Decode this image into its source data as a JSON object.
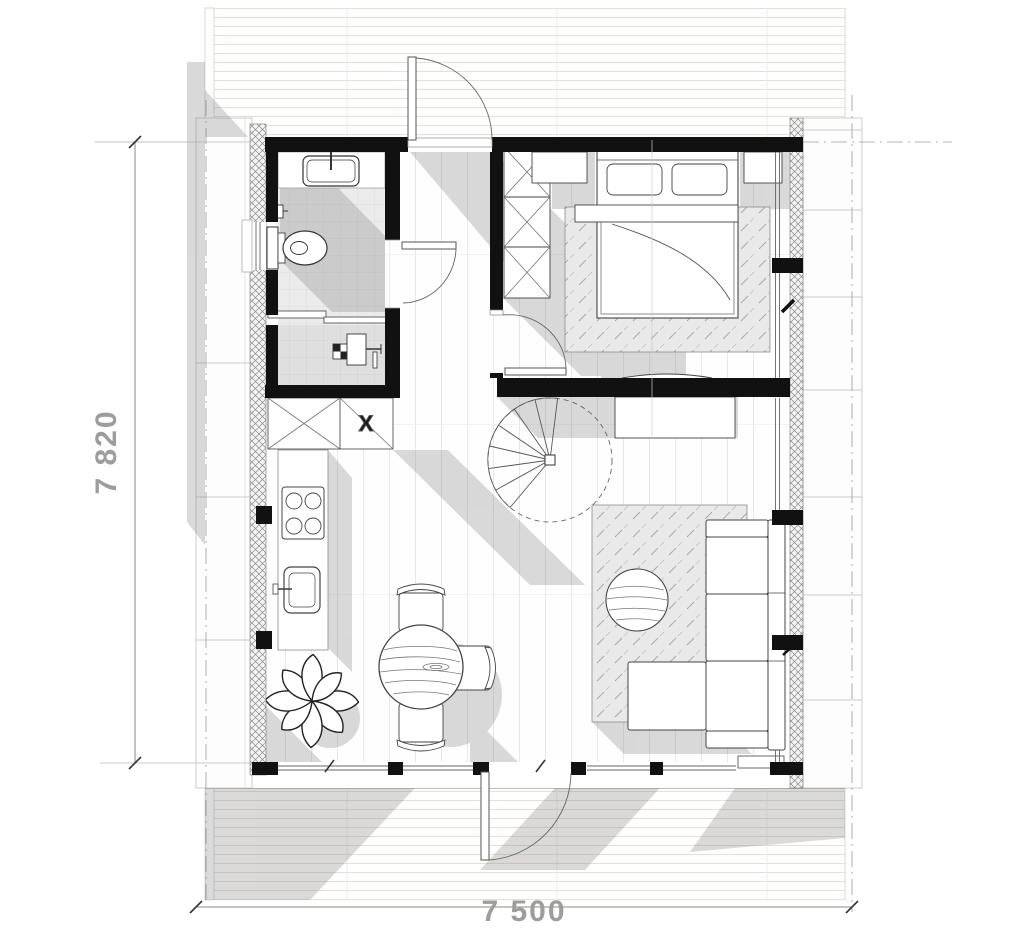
{
  "plan": {
    "dimensions": {
      "height_label": "7 820",
      "width_label": "7 500"
    },
    "markers": {
      "closet_mark": "X"
    },
    "colors": {
      "wall": "#111111",
      "dimension_text": "#9d9d9d",
      "shadow": "#d7d7d7",
      "deck_plank_line": "#eadfd2",
      "floor_plank_line": "#e8e8e8",
      "bathroom_tile": "#ebebeb",
      "furniture_outline": "#444444"
    },
    "elements": [
      "top-deck",
      "bottom-terrace",
      "left-walkway",
      "right-walkway",
      "entry-door",
      "bathroom",
      "vanity-sink",
      "toilet",
      "toilet-paper-holder",
      "sliding-door",
      "utility-room",
      "floor-drain",
      "water-heater",
      "closet",
      "wardrobe",
      "kitchen-counter",
      "cooktop",
      "kitchen-sink",
      "dining-table",
      "dining-chairs",
      "plant",
      "spiral-staircase",
      "hall",
      "bedroom",
      "double-bed",
      "nightstands",
      "bedroom-rug",
      "bedroom-door",
      "bathroom-door",
      "foot-shelf",
      "console-cabinet",
      "living-room",
      "living-rug",
      "pouf",
      "sofa",
      "ottoman",
      "window-bench",
      "terrace-door"
    ]
  }
}
